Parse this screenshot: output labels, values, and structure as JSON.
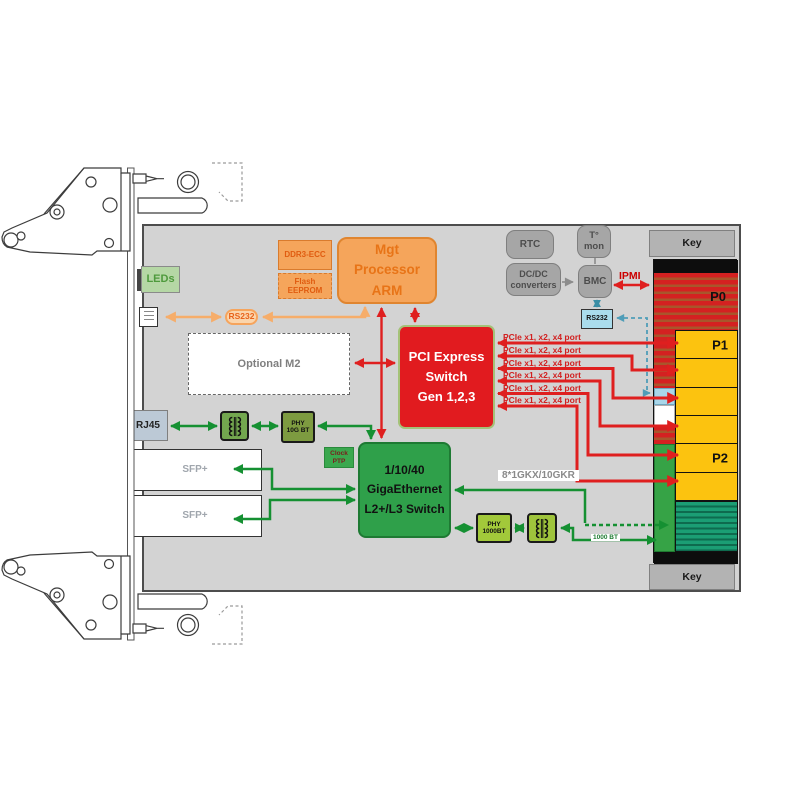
{
  "colors": {
    "board_gray": "#d3d3d3",
    "accent_red": "#df1f1f",
    "accent_green": "#159032",
    "accent_orange": "#f6ad6a",
    "connector_red": "#d42121",
    "connector_yellow": "#fcc30f",
    "connector_green": "#36a346",
    "connector_teal": "#1b9e74",
    "connector_blue": "#a9d6e9"
  },
  "front_panel": {
    "leds_label": "LEDs",
    "rj45_label": "RJ45",
    "sfp_top_label": "SFP+",
    "sfp_bottom_label": "SFP+"
  },
  "management": {
    "ddr3_label": "DDR3-ECC",
    "flash_lines": [
      "Flash",
      "EEPROM"
    ],
    "arm_lines": [
      "Mgt",
      "Processor",
      "ARM"
    ],
    "rs232_pill_label": "RS232",
    "optional_m2_label": "Optional M2"
  },
  "monitoring": {
    "rtc_label": "RTC",
    "tmon_lines": [
      "T°",
      "mon"
    ],
    "dcdc_lines": [
      "DC/DC",
      "converters"
    ],
    "bmc_label": "BMC",
    "ipmi_label": "IPMI",
    "rs232_box_label": "RS232"
  },
  "pcie": {
    "switch_lines": [
      "PCI Express",
      "Switch",
      "Gen 1,2,3"
    ],
    "port_labels": [
      "PCIe x1, x2, x4 port",
      "PCIe x1, x2, x4 port",
      "PCIe x1, x2, x4 port",
      "PCIe x1, x2, x4 port",
      "PCIe x1, x2, x4 port",
      "PCIe x1, x2, x4 port"
    ]
  },
  "ethernet": {
    "switch_lines": [
      "1/10/40",
      "GigaEthernet",
      "L2+/L3 Switch"
    ],
    "clock_lines": [
      "Clock",
      "PTP"
    ],
    "phy10g_lines": [
      "PHY",
      "10G BT"
    ],
    "phy1000_lines": [
      "PHY",
      "1000BT"
    ],
    "backplane_link_label": "8*1GKX/10GKR",
    "mgmt_port_label": "1000 BT"
  },
  "backplane": {
    "key_top_label": "Key",
    "key_bottom_label": "Key",
    "p0_label": "P0",
    "p1_label": "P1",
    "p2_label": "P2"
  }
}
